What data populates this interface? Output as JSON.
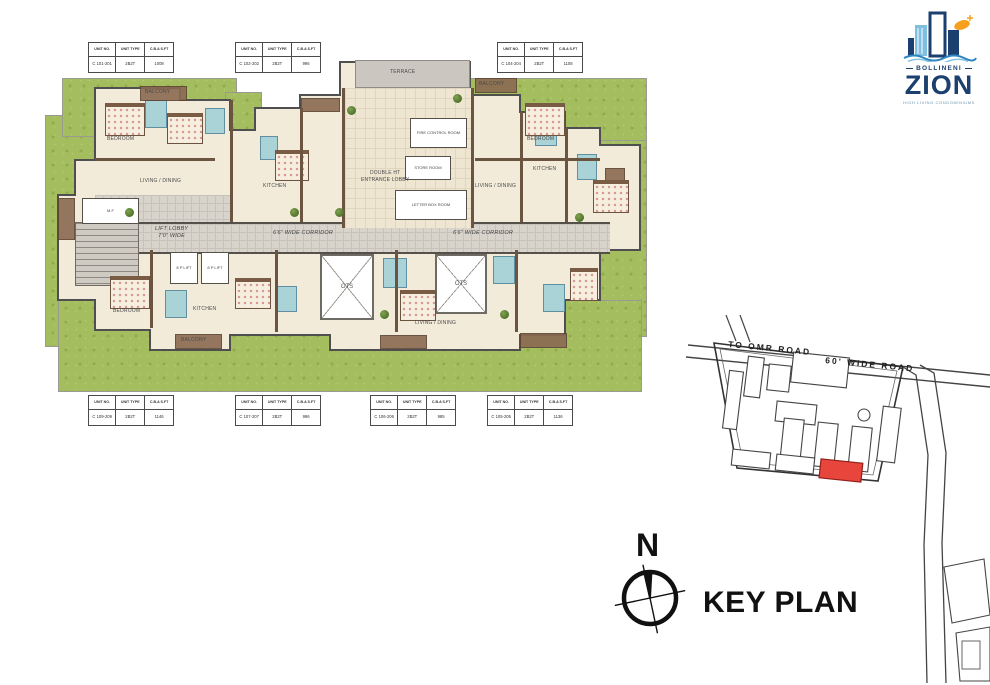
{
  "logo": {
    "brand_top": "BOLLINENI",
    "brand_main": "ZION",
    "tagline": "HIGH LIVING CONDOMINIUMS"
  },
  "unit_tables": {
    "headers": {
      "col1": "UNIT NO.",
      "col2": "UNIT TYPE",
      "col3": "C.B.A S.FT"
    },
    "top": [
      {
        "unit_no": "C 101-201",
        "unit_type": "2B2T",
        "cba": "1008"
      },
      {
        "unit_no": "C 102-202",
        "unit_type": "2B2T",
        "cba": "996"
      },
      {
        "unit_no": "C 104-204",
        "unit_type": "2B2T",
        "cba": "1108"
      }
    ],
    "bottom": [
      {
        "unit_no": "C 109-209",
        "unit_type": "2B2T",
        "cba": "1146"
      },
      {
        "unit_no": "C 107-207",
        "unit_type": "2B2T",
        "cba": "996"
      },
      {
        "unit_no": "C 106-206",
        "unit_type": "2B2T",
        "cba": "985"
      },
      {
        "unit_no": "C 105-205",
        "unit_type": "2B2T",
        "cba": "1136"
      }
    ]
  },
  "plan": {
    "labels": {
      "lift_lobby_line1": "LIFT LOBBY",
      "lift_lobby_line2": "7'0\" WIDE",
      "corridor": "6'6\" WIDE CORRIDOR",
      "ots": "OTS",
      "entrance_line1": "DOUBLE HT",
      "entrance_line2": "ENTRANCE LOBBY",
      "terrace": "TERRACE",
      "fire_control": "FIRE CONTROL ROOM",
      "store": "STORE ROOM",
      "letter_box": "LETTER BOX ROOM",
      "lift": "8 P LIFT",
      "mf": "M.F",
      "bedroom": "BEDROOM",
      "living": "LIVING / DINING",
      "kitchen": "KITCHEN",
      "balcony": "BALCONY"
    }
  },
  "key_plan": {
    "title": "KEY PLAN",
    "road_label_1": "TO OMR ROAD",
    "road_label_2": "60' WIDE ROAD",
    "compass_n": "N"
  },
  "colors": {
    "accent_red": "#E8453C",
    "logo_navy": "#1B3F6E",
    "logo_blue": "#6FB4DC",
    "logo_orange": "#F6A01D",
    "lawn_green": "#A3BD5F",
    "floor_cream": "#F0E8D6",
    "wall_brown": "#6B5440",
    "bath_teal": "#A9D3D6",
    "corridor_gray": "#D8D4CC"
  }
}
